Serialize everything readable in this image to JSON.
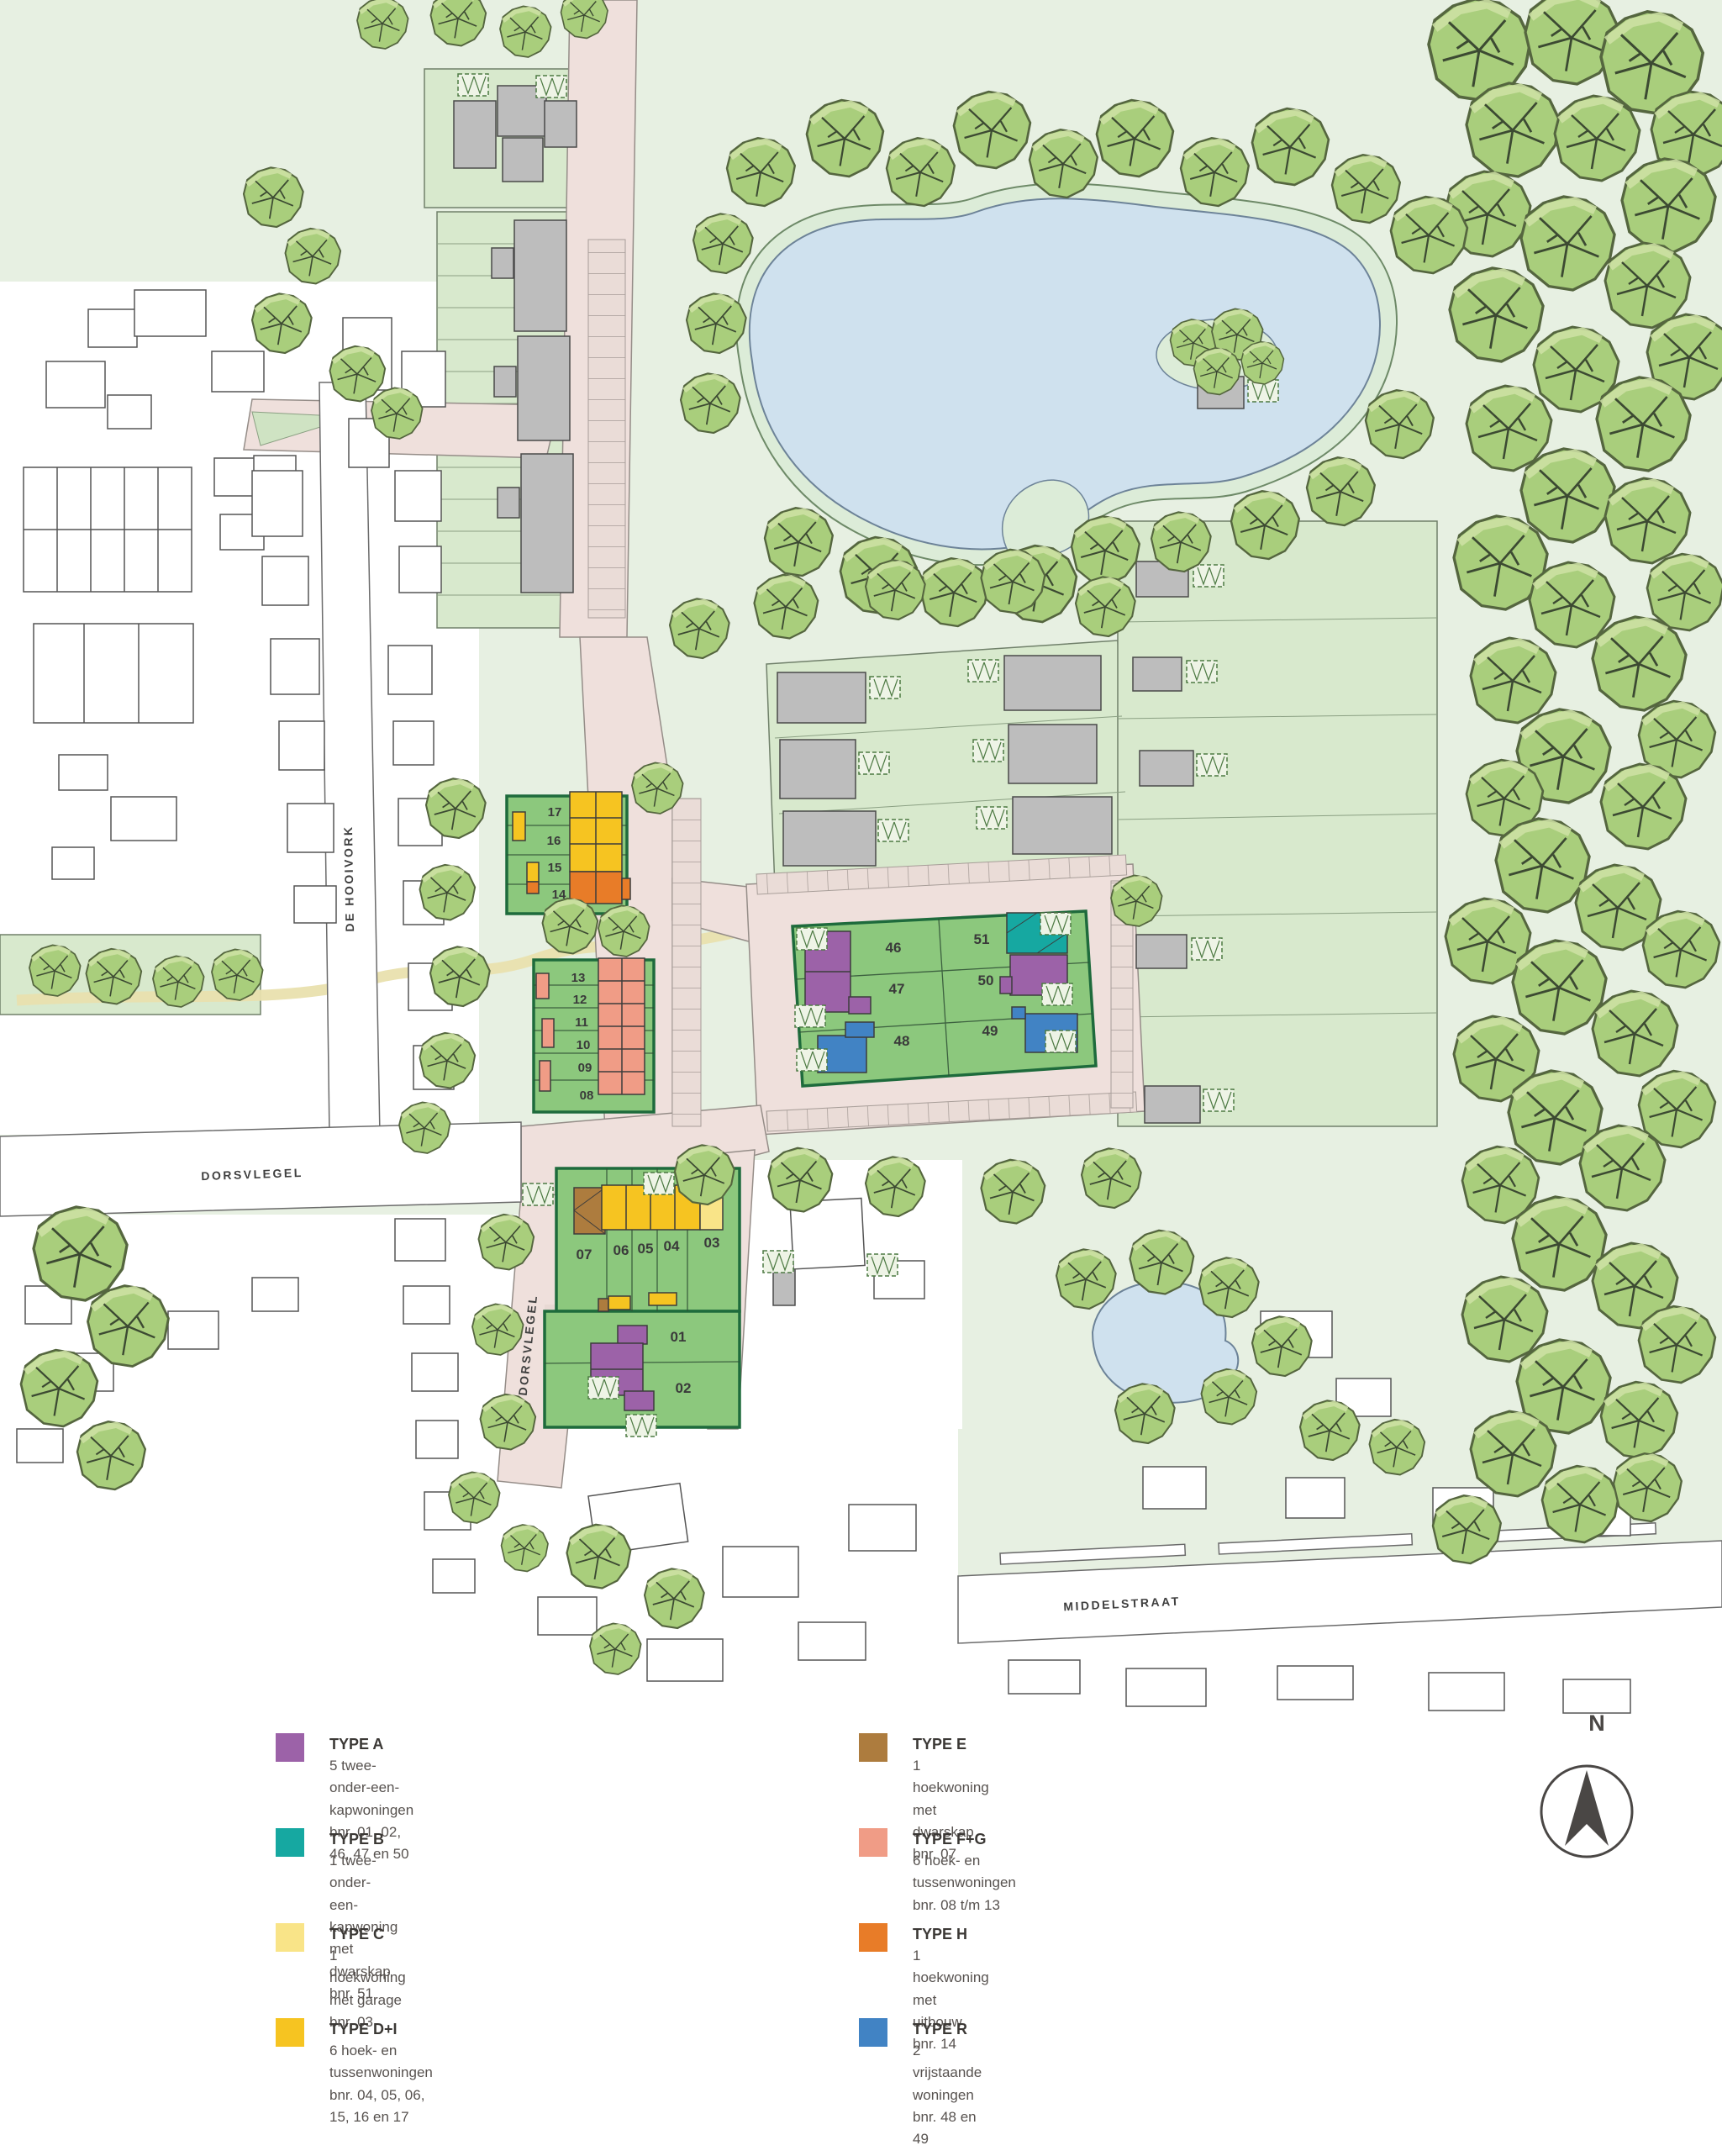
{
  "map": {
    "north_label": "N",
    "streets": {
      "de_hooivork": "DE HOOIVORK",
      "dorsvlegel_west": "DORSVLEGEL",
      "dorsvlegel_south": "DORSVLEGEL",
      "middelstraat": "MIDDELSTRAAT"
    },
    "plots": {
      "p01": "01",
      "p02": "02",
      "p03": "03",
      "p04": "04",
      "p05": "05",
      "p06": "06",
      "p07": "07",
      "p08": "08",
      "p09": "09",
      "p10": "10",
      "p11": "11",
      "p12": "12",
      "p13": "13",
      "p14": "14",
      "p15": "15",
      "p16": "16",
      "p17": "17",
      "p46": "46",
      "p47": "47",
      "p48": "48",
      "p49": "49",
      "p50": "50",
      "p51": "51"
    },
    "palette": {
      "background_green": "#e7f0e2",
      "field_green": "#d8e9cd",
      "development_green": "#8cc87d",
      "road_pink": "#efe0dc",
      "water_blue": "#cfe1ee"
    }
  },
  "legend": {
    "items": [
      {
        "id": "type-a",
        "color": "#9c62a8",
        "label": "TYPE A",
        "desc": "5 twee-onder-een-kapwoningen",
        "bnr": "bnr. 01, 02, 46, 47 en 50"
      },
      {
        "id": "type-b",
        "color": "#16a8a1",
        "label": "TYPE B",
        "desc": "1 twee-onder-een-kapwoning met dwarskap",
        "bnr": "bnr. 51"
      },
      {
        "id": "type-c",
        "color": "#f9e488",
        "label": "TYPE C",
        "desc": "1 hoekwoning met garage",
        "bnr": "bnr. 03"
      },
      {
        "id": "type-di",
        "color": "#f6c421",
        "label": "TYPE D+I",
        "desc": "6 hoek- en tussenwoningen",
        "bnr": "bnr. 04, 05, 06, 15, 16 en 17"
      },
      {
        "id": "type-e",
        "color": "#ad7c3e",
        "label": "TYPE E",
        "desc": "1 hoekwoning met dwarskap",
        "bnr": "bnr. 07"
      },
      {
        "id": "type-fg",
        "color": "#f09c86",
        "label": "TYPE F+G",
        "desc": "6 hoek- en tussenwoningen",
        "bnr": "bnr. 08 t/m 13"
      },
      {
        "id": "type-h",
        "color": "#e87c28",
        "label": "TYPE H",
        "desc": "1 hoekwoning met uitbouw",
        "bnr": "bnr. 14"
      },
      {
        "id": "type-r",
        "color": "#4183c4",
        "label": "TYPE R",
        "desc": "2 vrijstaande woningen",
        "bnr": "bnr. 48 en 49"
      }
    ]
  }
}
